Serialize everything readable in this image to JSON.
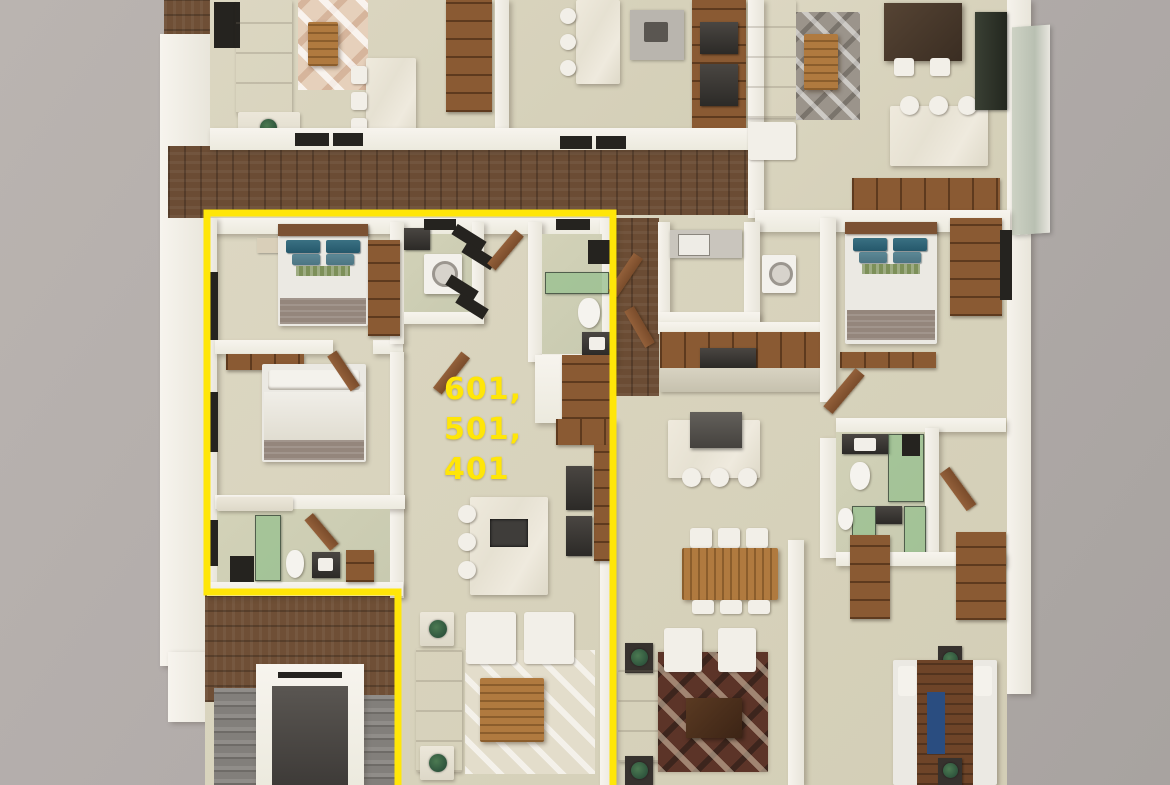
{
  "scene": {
    "description": "3D rendered top-down floor plan of a residential building level; left unit outlined in yellow",
    "background_color": "#b2acaa"
  },
  "highlight": {
    "label_text": "601, 501, 401",
    "label_lines": [
      "601,",
      "501,",
      "401"
    ],
    "outline_color": "#ffe608"
  },
  "palette": {
    "floor_beige": "#d8d3bd",
    "wall_white": "#f4f1ea",
    "corridor_wood": "#6b4c34",
    "cabinet_wood": "#8a5a33",
    "stairs_gray": "#84817d",
    "elevator_dark": "#514d4a",
    "sofa_cream": "#e6e1d4",
    "pillow_teal": "#2f6475",
    "shower_glass_green": "#98c090",
    "rug_pattern_dark": "#5c3428",
    "marble_counter": "#ece7dc",
    "fixture_black": "#25231f"
  }
}
